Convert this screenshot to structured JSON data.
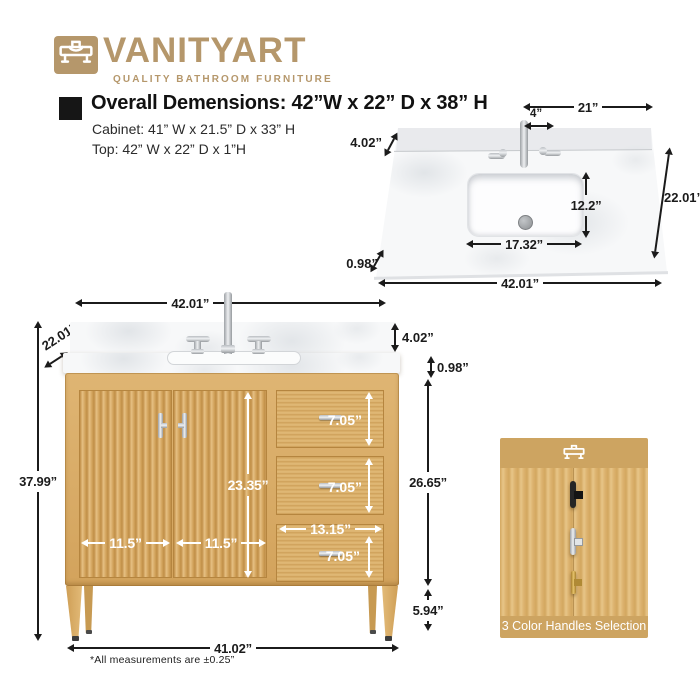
{
  "brand": {
    "wordmark": "VANITYART",
    "tagline": "QUALITY BATHROOM FURNITURE",
    "logo_icon": "vanity-sink-icon",
    "gold": "#b5976b"
  },
  "specs": {
    "overall": "Overall Demensions: 42”W x 22” D x 38” H",
    "cabinet": "Cabinet: 41” W x 21.5” D x 33” H",
    "top": "Top: 42” W x 22” D x 1”H"
  },
  "top_view_dims": {
    "edge_to_faucet": "21”",
    "faucet_offset": "4”",
    "backsplash_depth": "4.02”",
    "sink_depth": "12.2”",
    "counter_depth": "22.01”",
    "sink_width": "17.32”",
    "front_edge": "0.98”",
    "counter_width": "42.01”"
  },
  "front_view_dims": {
    "counter_width": "42.01”",
    "counter_depth": "22.01”",
    "backsplash_height": "4.02”",
    "counter_thickness": "0.98”",
    "overall_height": "37.99”",
    "drawer1_height": "7.05”",
    "drawer2_height": "7.05”",
    "drawer3_height": "7.05”",
    "door_height": "23.35”",
    "cabinet_face_height": "26.65”",
    "drawer_width": "13.15”",
    "door1_width": "11.5”",
    "door2_width": "11.5”",
    "leg_height": "5.94”",
    "base_width": "41.02”"
  },
  "handles_panel": {
    "title": "3 Color Handles Selection",
    "options": [
      "Black",
      "Chrome",
      "Gold"
    ]
  },
  "footnote": "*All measurements are ±0.25”",
  "colors": {
    "brand_gold": "#b5976b",
    "wood": "#d9ad6a",
    "panel_tan": "#cda461",
    "matte_black": "#2a2a2a",
    "chrome": "#c9ccd0",
    "handle_gold": "#c59a44"
  }
}
